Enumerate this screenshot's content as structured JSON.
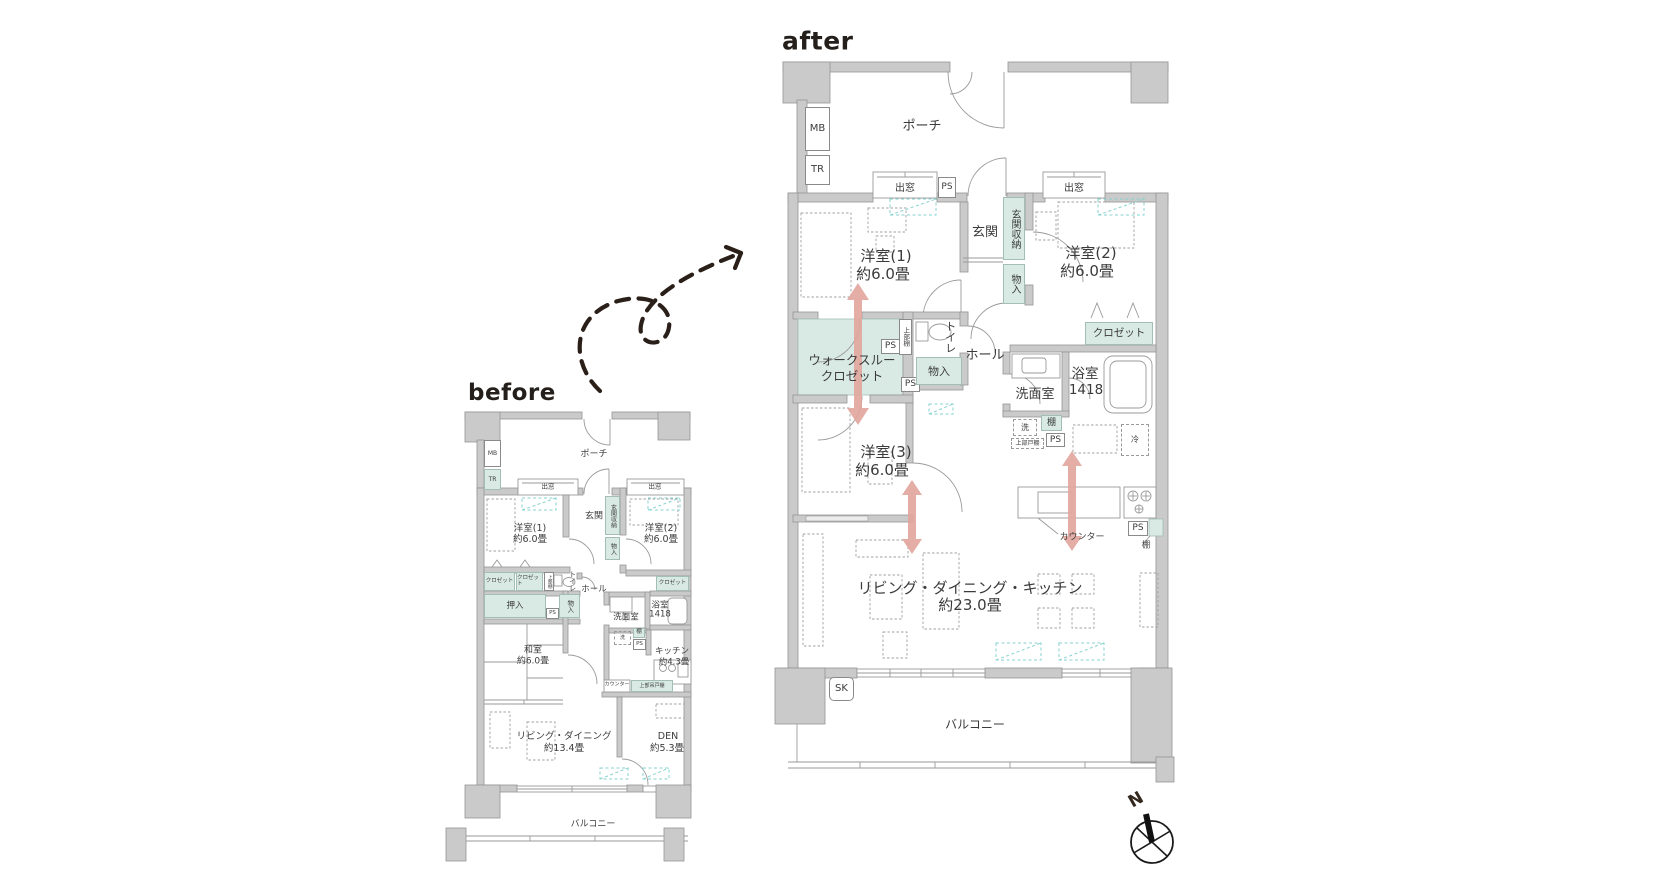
{
  "meta": {
    "after_label": "after",
    "before_label": "before",
    "compass_north": "N"
  },
  "colors": {
    "wall": "#cacaca",
    "storage_teal": "#d9eae5",
    "arrow_pink": "#e2a69d",
    "light_cyan": "#86d2cf",
    "ink": "#3b3b3b"
  },
  "after": {
    "porch": "ポーチ",
    "mb": "MB",
    "tr": "TR",
    "bay_window": "出窓",
    "ps": "PS",
    "genkan": "玄関",
    "genkan_storage": "玄関収納",
    "monoire": "物入",
    "western1": "洋室(1)",
    "western1_size": "約6.0畳",
    "western2": "洋室(2)",
    "western2_size": "約6.0畳",
    "western3": "洋室(3)",
    "western3_size": "約6.0畳",
    "wtc_line1": "ウォークスルー",
    "wtc_line2": "クロゼット",
    "upper_shelf": "上部棚",
    "toilet": "トイレ",
    "hall": "ホール",
    "closet": "クロゼット",
    "bath": "浴室",
    "bath_size": "1418",
    "washroom": "洗面室",
    "shelf": "棚",
    "washer": "洗",
    "upper_cabinet": "上部戸棚",
    "fridge": "冷",
    "counter": "カウンター",
    "ldk": "リビング・ダイニング・キッチン",
    "ldk_size": "約23.0畳",
    "sk": "SK",
    "balcony": "バルコニー"
  },
  "before": {
    "porch": "ポーチ",
    "mb": "MB",
    "tr": "TR",
    "bay_window": "出窓",
    "ps": "PS",
    "genkan": "玄関",
    "genkan_storage": "玄関収納",
    "monoire": "物入",
    "western1": "洋室(1)",
    "western1_size": "約6.0畳",
    "western2": "洋室(2)",
    "western2_size": "約6.0畳",
    "closet": "クロゼット",
    "upper_shelf": "上部棚",
    "toilet": "トイレ",
    "hall": "ホール",
    "oshiire": "押入",
    "washroom": "洗面室",
    "bath": "浴室",
    "bath_size": "1418",
    "washer": "洗",
    "shelf": "棚",
    "kitchen": "キッチン",
    "kitchen_size": "約4.3畳",
    "washitsu": "和室",
    "washitsu_size": "約6.0畳",
    "counter": "カウンター",
    "upper_hanging_cabinet": "上部吊戸棚",
    "living_dining": "リビング・ダイニング",
    "living_dining_size": "約13.4畳",
    "den": "DEN",
    "den_size": "約5.3畳",
    "balcony": "バルコニー"
  }
}
